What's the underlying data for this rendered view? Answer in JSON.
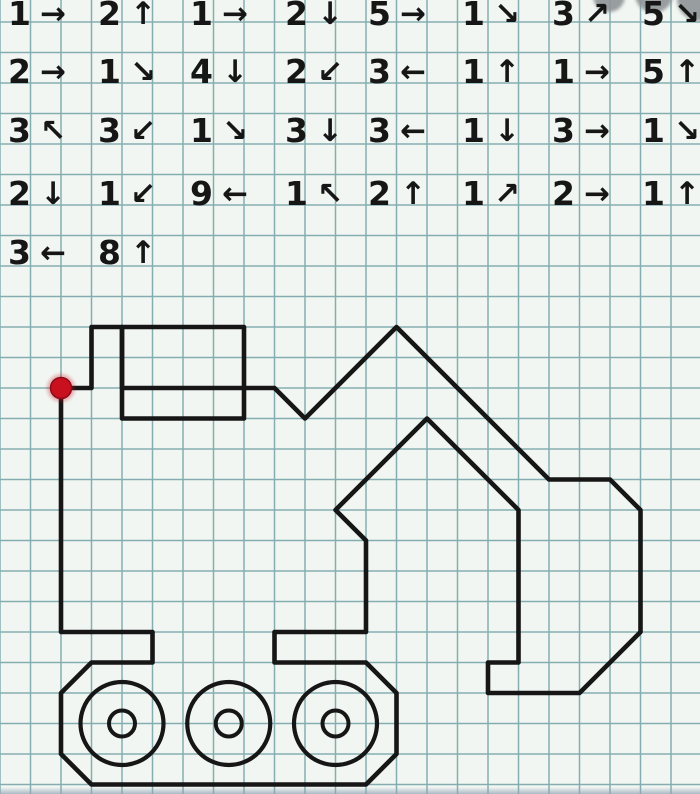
{
  "palette": {
    "paper": "#f2f6f3",
    "grid_line": "#84adb1",
    "ink": "#161616",
    "start_dot": "#c8101f",
    "watermark": "#8f9496",
    "edge": "#92a5b4"
  },
  "instructions": {
    "rows": [
      {
        "steps": [
          {
            "n": "1",
            "dir": "right",
            "arrow": "→"
          },
          {
            "n": "2",
            "dir": "up",
            "arrow": "↑"
          },
          {
            "n": "1",
            "dir": "right",
            "arrow": "→"
          },
          {
            "n": "2",
            "dir": "down",
            "arrow": "↓"
          },
          {
            "n": "5",
            "dir": "right",
            "arrow": "→"
          },
          {
            "n": "1",
            "dir": "down-right",
            "arrow": "↘"
          },
          {
            "n": "3",
            "dir": "up-right",
            "arrow": "↗"
          },
          {
            "n": "5",
            "dir": "down-right",
            "arrow": "↘"
          }
        ]
      },
      {
        "steps": [
          {
            "n": "2",
            "dir": "right",
            "arrow": "→"
          },
          {
            "n": "1",
            "dir": "down-right",
            "arrow": "↘"
          },
          {
            "n": "4",
            "dir": "down",
            "arrow": "↓"
          },
          {
            "n": "2",
            "dir": "down-left",
            "arrow": "↙"
          },
          {
            "n": "3",
            "dir": "left",
            "arrow": "←"
          },
          {
            "n": "1",
            "dir": "up",
            "arrow": "↑"
          },
          {
            "n": "1",
            "dir": "right",
            "arrow": "→"
          },
          {
            "n": "5",
            "dir": "up",
            "arrow": "↑"
          }
        ]
      },
      {
        "steps": [
          {
            "n": "3",
            "dir": "up-left",
            "arrow": "↖"
          },
          {
            "n": "3",
            "dir": "down-left",
            "arrow": "↙"
          },
          {
            "n": "1",
            "dir": "down-right",
            "arrow": "↘"
          },
          {
            "n": "3",
            "dir": "down",
            "arrow": "↓"
          },
          {
            "n": "3",
            "dir": "left",
            "arrow": "←"
          },
          {
            "n": "1",
            "dir": "down",
            "arrow": "↓"
          },
          {
            "n": "3",
            "dir": "right",
            "arrow": "→"
          },
          {
            "n": "1",
            "dir": "down-right",
            "arrow": "↘"
          }
        ]
      },
      {
        "steps": [
          {
            "n": "2",
            "dir": "down",
            "arrow": "↓"
          },
          {
            "n": "1",
            "dir": "down-left",
            "arrow": "↙"
          },
          {
            "n": "9",
            "dir": "left",
            "arrow": "←"
          },
          {
            "n": "1",
            "dir": "up-left",
            "arrow": "↖"
          },
          {
            "n": "2",
            "dir": "up",
            "arrow": "↑"
          },
          {
            "n": "1",
            "dir": "up-right",
            "arrow": "↗"
          },
          {
            "n": "2",
            "dir": "right",
            "arrow": "→"
          },
          {
            "n": "1",
            "dir": "up",
            "arrow": "↑"
          }
        ]
      },
      {
        "steps": [
          {
            "n": "3",
            "dir": "left",
            "arrow": "←"
          },
          {
            "n": "8",
            "dir": "up",
            "arrow": "↑"
          }
        ]
      }
    ]
  },
  "drawing": {
    "figure": "excavator",
    "grid_cell_px": 30.5,
    "start_point_px": {
      "x": 61,
      "y": 388
    },
    "outline_cells": [
      [
        0,
        0
      ],
      [
        1,
        0
      ],
      [
        1,
        2
      ],
      [
        2,
        2
      ],
      [
        2,
        0
      ],
      [
        7,
        0
      ],
      [
        8,
        -1
      ],
      [
        11,
        2
      ],
      [
        16,
        -3
      ],
      [
        18,
        -3
      ],
      [
        19,
        -4
      ],
      [
        19,
        -8
      ],
      [
        17,
        -10
      ],
      [
        14,
        -10
      ],
      [
        14,
        -9
      ],
      [
        15,
        -9
      ],
      [
        15,
        -4
      ],
      [
        12,
        -1
      ],
      [
        9,
        -4
      ],
      [
        10,
        -5
      ],
      [
        10,
        -8
      ],
      [
        7,
        -8
      ],
      [
        7,
        -9
      ],
      [
        10,
        -9
      ],
      [
        11,
        -10
      ],
      [
        11,
        -12
      ],
      [
        10,
        -13
      ],
      [
        1,
        -13
      ],
      [
        0,
        -12
      ],
      [
        0,
        -10
      ],
      [
        1,
        -9
      ],
      [
        3,
        -9
      ],
      [
        3,
        -8
      ],
      [
        0,
        -8
      ]
    ],
    "cab_window_cells": {
      "x": 2,
      "y_top": -2,
      "w": 4,
      "h": 3
    },
    "wheels": [
      {
        "cx_cells": 2,
        "cy_cells": -11
      },
      {
        "cx_cells": 5.5,
        "cy_cells": -11
      },
      {
        "cx_cells": 9,
        "cy_cells": -11
      }
    ],
    "wheel_outer_radius_px": 41.5,
    "wheel_hub_radius_px": 13,
    "start_dot_radius_px": 10.5,
    "stroke_width_px": 4.6
  },
  "watermark": {
    "circles": [
      {
        "x": 609,
        "y": -4,
        "r": 16
      },
      {
        "x": 654,
        "y": -6,
        "r": 19
      },
      {
        "x": 699,
        "y": -1,
        "r": 22
      }
    ]
  },
  "layout_note": ""
}
